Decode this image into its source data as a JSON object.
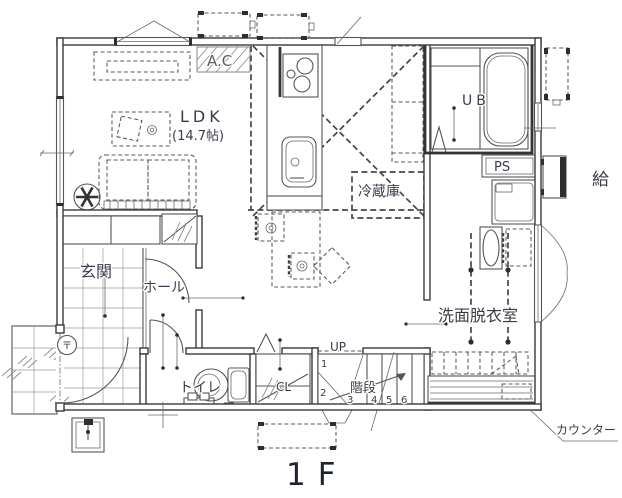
{
  "title": "1F",
  "floor_plan": {
    "rooms": {
      "ldk": "LDK",
      "ldk_area": "(14.7帖)",
      "genkan": "玄関",
      "hall": "ホール",
      "toilet": "トイレ",
      "washroom": "洗面脱衣室",
      "stairs": "階段",
      "unit_bath": "UB",
      "closet": "CL"
    },
    "labels": {
      "ac": "A.C",
      "ps": "PS",
      "refrigerator": "冷蔵庫",
      "water_heater": "給",
      "up": "UP",
      "counter": "カウンター",
      "post_mark": "〒"
    },
    "stair_steps": [
      "1",
      "2",
      "3",
      "4",
      "5",
      "6"
    ]
  },
  "colors": {
    "background": "#ffffff",
    "line": "#555555",
    "wall": "#3a3a3a",
    "text": "#3b3b4c"
  }
}
